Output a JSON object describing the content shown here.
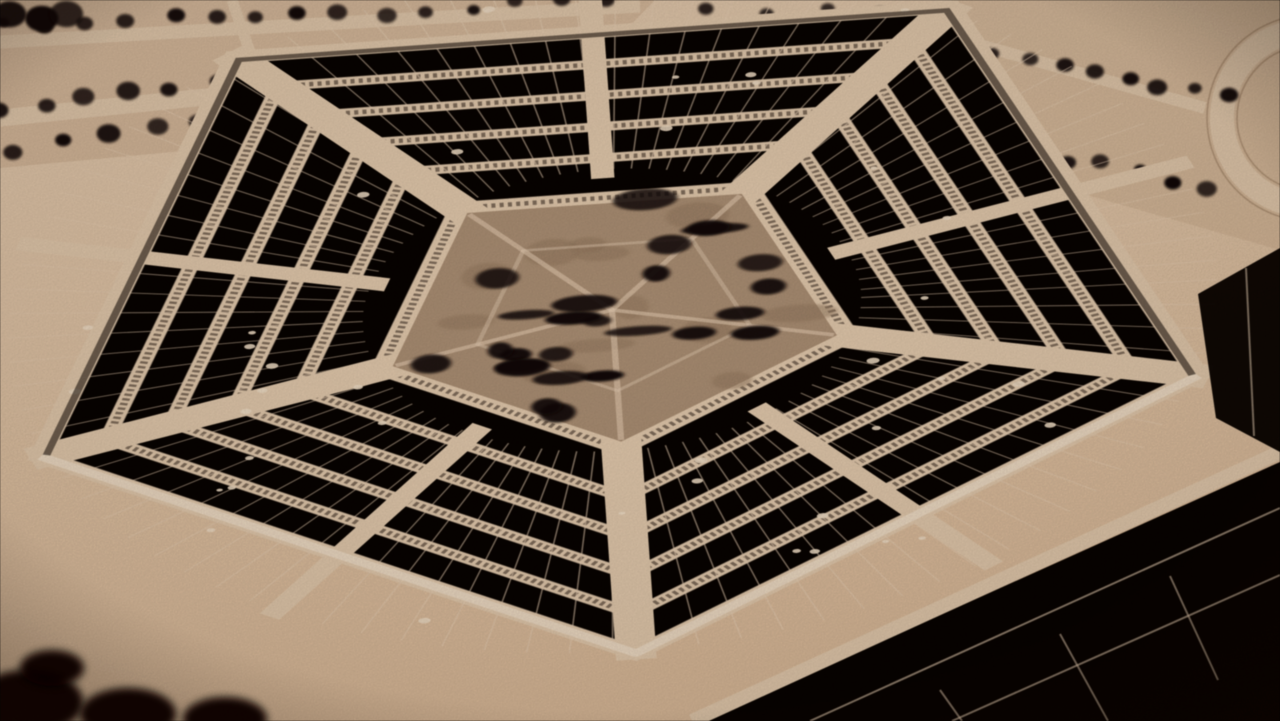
{
  "image": {
    "title": "Sepia-toned oblique aerial photograph of the Pentagon",
    "description": "Archival black-and-white film still, sepia tinted. The Pentagon building fills the frame, viewed from above at an angle: five concentric pentagonal rings of dark flat rooftops separated by light-toned light-wells, wide light radial corridors, thin roof seam lines and small white roof vents. The central pentagonal courtyard is planted with dark tree clusters. Tree-lined access roads and lawns run along the top of the frame with a curved loop road at the top right; the building is cropped by the frame at the bottom and right; deep shadow mass sits in the bottom-left corner.",
    "type": "photograph",
    "subject": "The Pentagon, oblique aerial view",
    "monochrome": true,
    "tone": "sepia"
  },
  "palette": {
    "light_road": "#e8cfb2",
    "light_highlight": "#f4e1c9",
    "road_shadow": "#9a7c5f",
    "lawn": "#d2b394",
    "courtyard_ground": "#b09479",
    "courtyard_shade": "#977c62",
    "roof_dark": "#0d0805",
    "roof_deep": "#070402",
    "tree_dark": "#140d08",
    "window_band": "#231710",
    "seam_light": "#ecd3b8",
    "vignette": "#180d06",
    "bg_top": "#e9d0b4",
    "bg_bottom": "#e0c09f"
  },
  "scene": {
    "building": "The Pentagon",
    "concentric_rings": 5,
    "vertex_corridors": 5,
    "mid_edge_corridors": 5,
    "courtyard_trees": 26,
    "roof_vents": 40,
    "roof_seam_lines": 88,
    "crop": "building cut off by frame at bottom and right edges",
    "surroundings": [
      "rows of dark trees along light access roads at top",
      "curved loop road at top right",
      "lawn areas at top left and top right",
      "dark shadow and tree mass in bottom-left corner"
    ]
  }
}
